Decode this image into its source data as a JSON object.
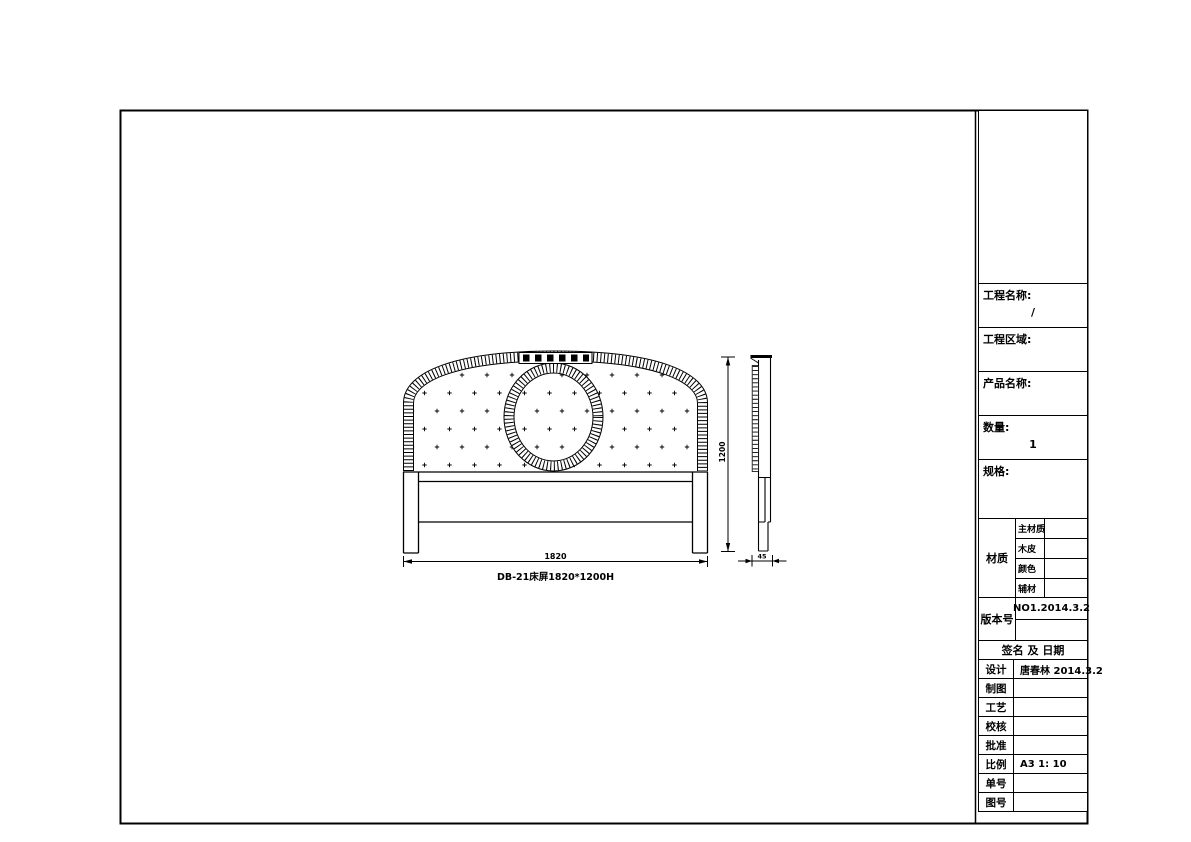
{
  "colors": {
    "line": "#000000",
    "background": "#ffffff"
  },
  "drawing": {
    "front_view": {
      "name_label": "DB-21床屏1820*1200H",
      "width_dim": "1820"
    },
    "height_dim": "1200",
    "side_view": {
      "thickness_dim": "45"
    }
  },
  "title_block": {
    "top_rows": [
      {
        "label": "工程名称:",
        "value": "/"
      },
      {
        "label": "工程区域:",
        "value": ""
      },
      {
        "label": "产品名称:",
        "value": ""
      },
      {
        "label": "数量:",
        "value": "1"
      },
      {
        "label": "规格:",
        "value": ""
      }
    ],
    "material": {
      "label": "材质",
      "rows": [
        {
          "label": "主材质",
          "value": ""
        },
        {
          "label": "木皮",
          "value": ""
        },
        {
          "label": "颜色",
          "value": ""
        },
        {
          "label": "辅材",
          "value": ""
        }
      ]
    },
    "version": {
      "label": "版本号",
      "value": "NO1.2014.3.2"
    },
    "sign_header": "签名 及 日期",
    "sign_rows": [
      {
        "label": "设计",
        "value": "唐春林 2014.3.2"
      },
      {
        "label": "制图",
        "value": ""
      },
      {
        "label": "工艺",
        "value": ""
      },
      {
        "label": "校核",
        "value": ""
      },
      {
        "label": "批准",
        "value": ""
      },
      {
        "label": "比例",
        "value": "A3 1: 10"
      },
      {
        "label": "单号",
        "value": ""
      },
      {
        "label": "图号",
        "value": ""
      }
    ]
  }
}
